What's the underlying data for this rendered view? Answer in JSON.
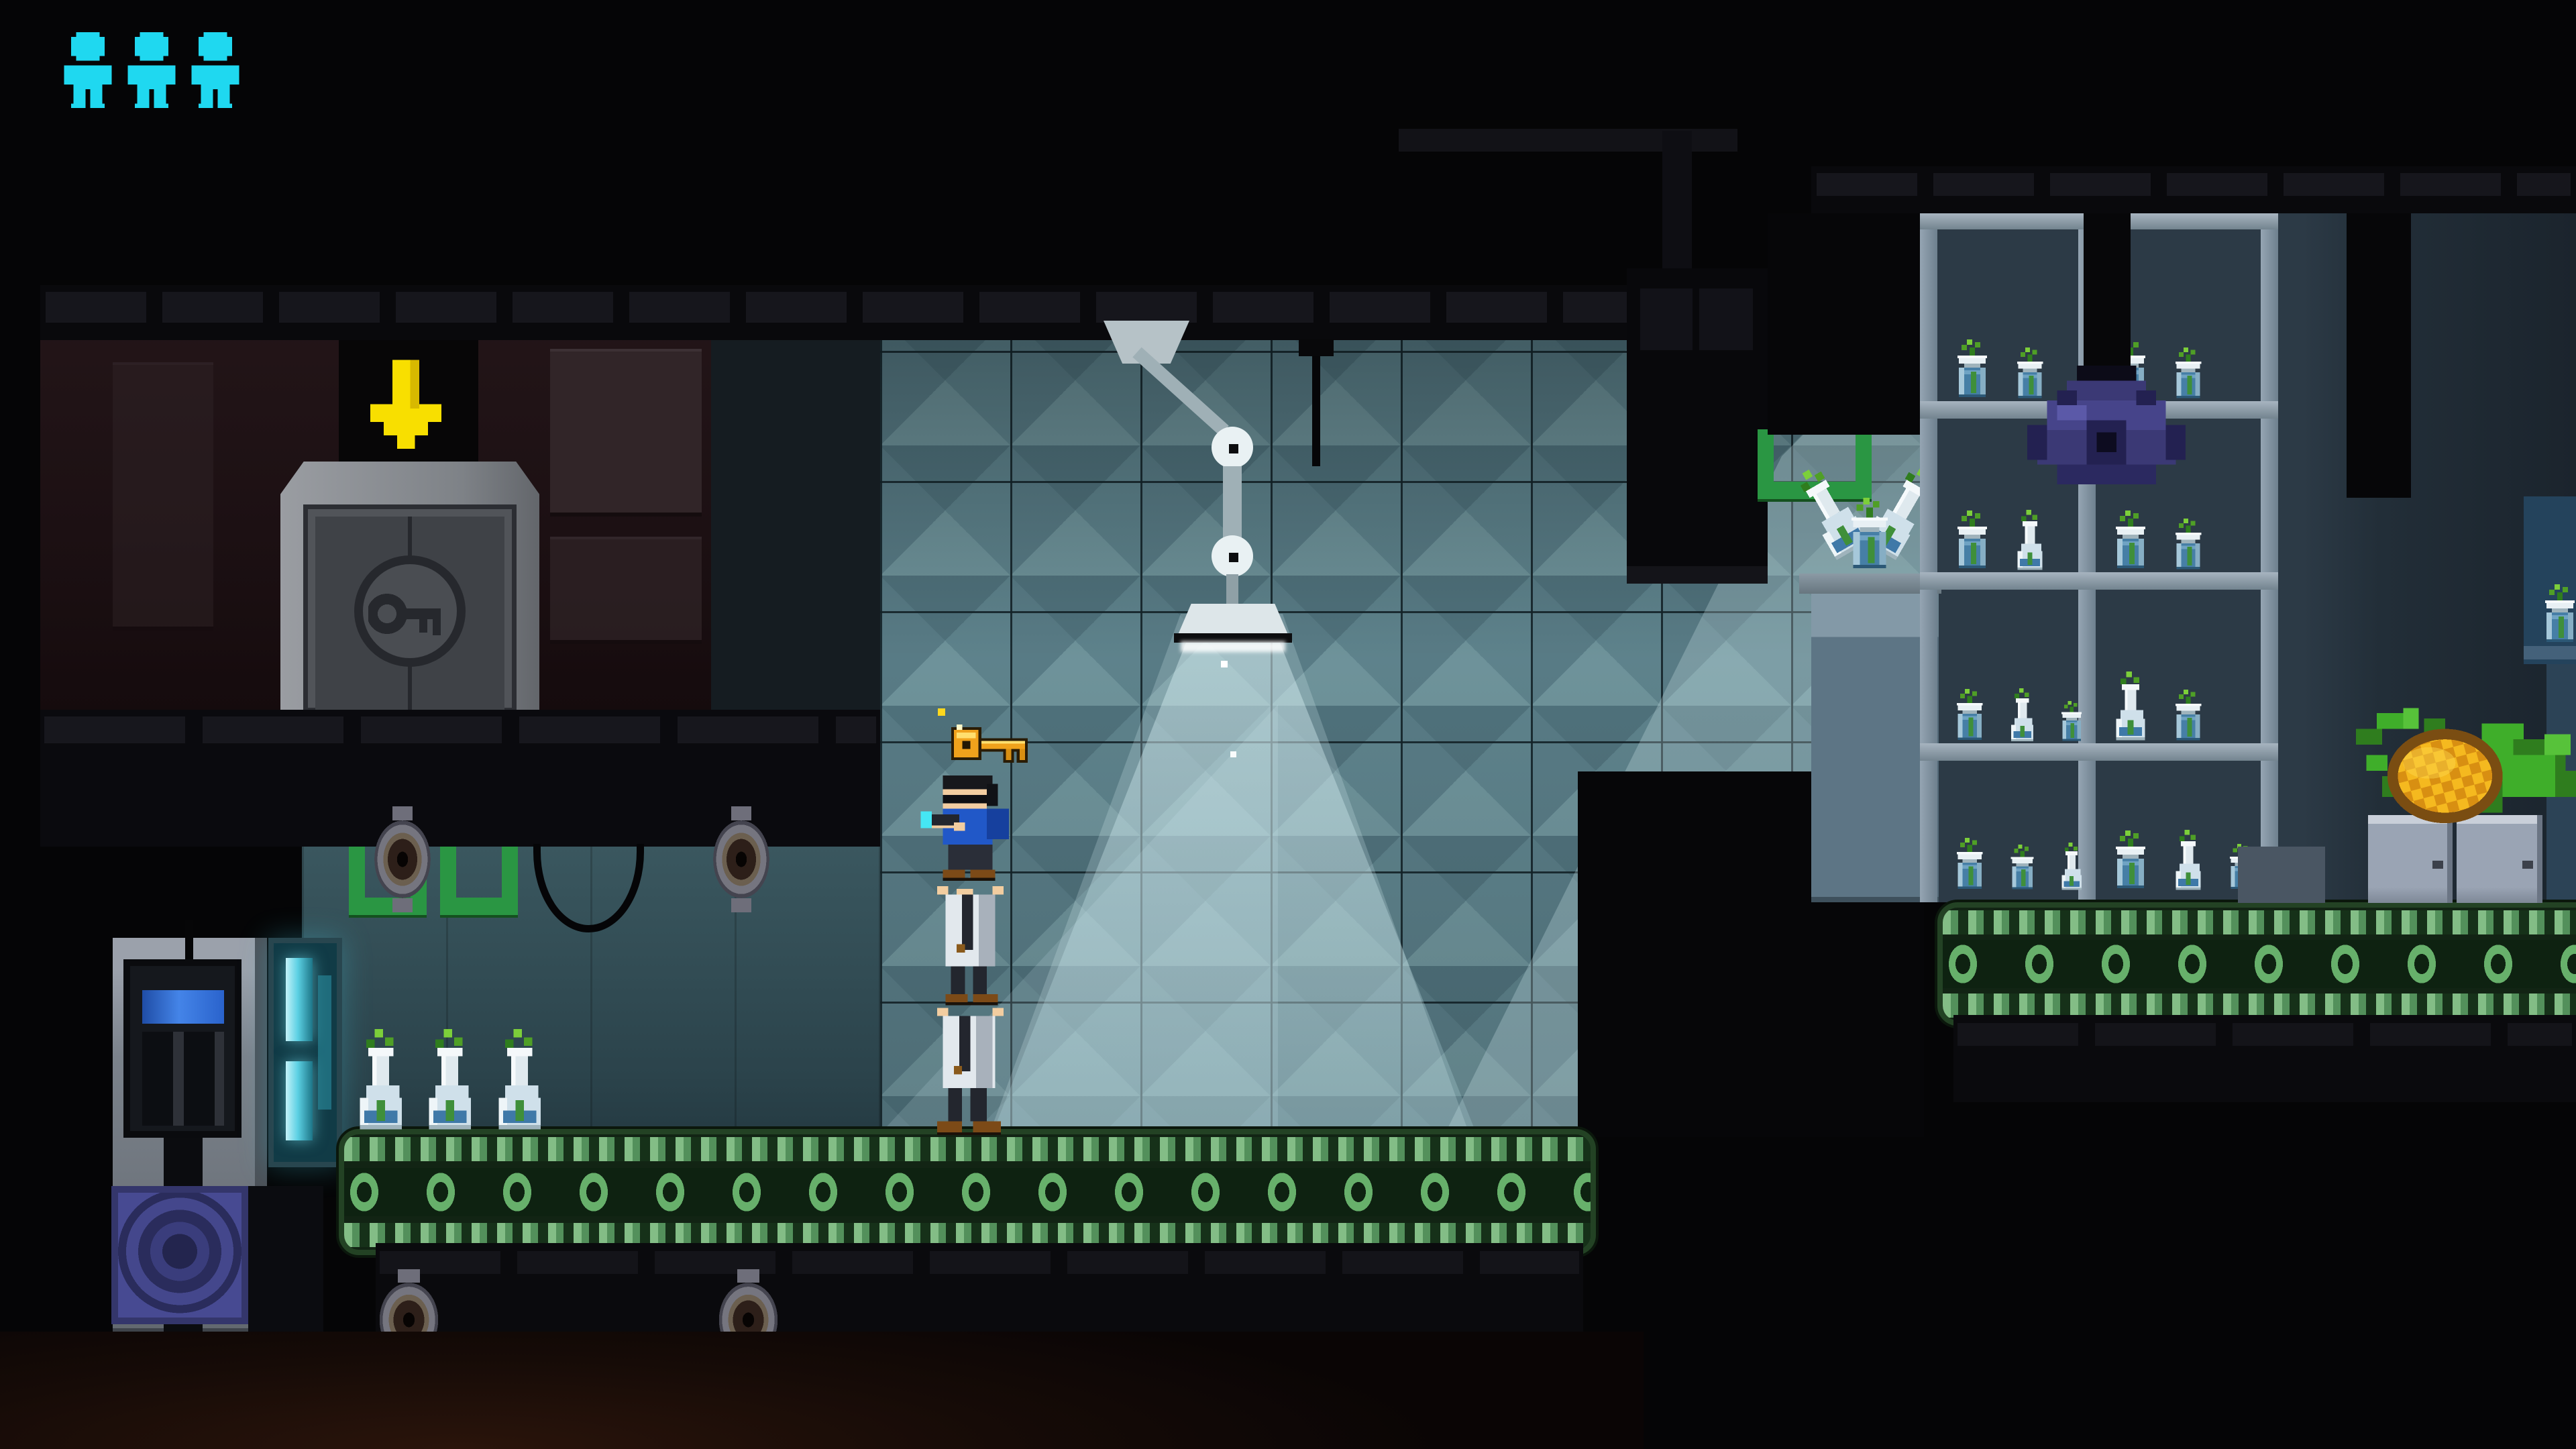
{
  "app": {
    "type": "pixel-art stealth platformer",
    "scene": "laboratory conveyor room"
  },
  "hud": {
    "lives": 3,
    "life_icon": "person-icon"
  },
  "palette": {
    "cyan": "#1fd8f0",
    "gold": "#f0a21c",
    "arrow-yellow": "#f8df00",
    "belt-green": "#234224",
    "ring-green": "#67b06b",
    "camera-purple": "#45438a",
    "wall-teal": "#6f97a1",
    "wall-maroon": "#1e1214",
    "lamp-metal": "#cdd9dc"
  },
  "entities": {
    "player": {
      "label": "player stack — agent with glowing pistol standing on two lab-coat figures"
    },
    "key": {
      "label": "golden key floating above player"
    },
    "door": {
      "label": "locked exit door with key emblem"
    },
    "exit_marker": {
      "label": "yellow down arrow above door"
    },
    "lamp": {
      "label": "articulated ceiling lamp casting light cone"
    },
    "camera": {
      "label": "purple ceiling-mounted scanner dome"
    },
    "fruit": {
      "label": "pineapple with leaves on lockers"
    },
    "jars": {
      "label": "specimen jars with sprouting plants"
    },
    "conveyors": {
      "count": 2,
      "label": "green conveyor belts"
    }
  },
  "shelves": {
    "cells": [
      {
        "count": 2,
        "types": [
          "jar",
          "jar"
        ]
      },
      {
        "count": 2,
        "types": [
          "jar",
          "jar"
        ]
      },
      {
        "count": 2,
        "types": [
          "jar",
          "flask"
        ]
      },
      {
        "count": 2,
        "types": [
          "jar",
          "jar"
        ]
      },
      {
        "count": 3,
        "types": [
          "jar",
          "flask",
          "jar"
        ]
      },
      {
        "count": 2,
        "types": [
          "flask",
          "jar"
        ]
      },
      {
        "count": 3,
        "types": [
          "jar",
          "jar",
          "flask"
        ]
      },
      {
        "count": 3,
        "types": [
          "jar",
          "flask",
          "jar"
        ]
      },
      {
        "count": 1,
        "types": [
          "jar"
        ]
      },
      {
        "count": 3,
        "types": [
          "flask",
          "flask",
          "flask"
        ]
      }
    ]
  }
}
